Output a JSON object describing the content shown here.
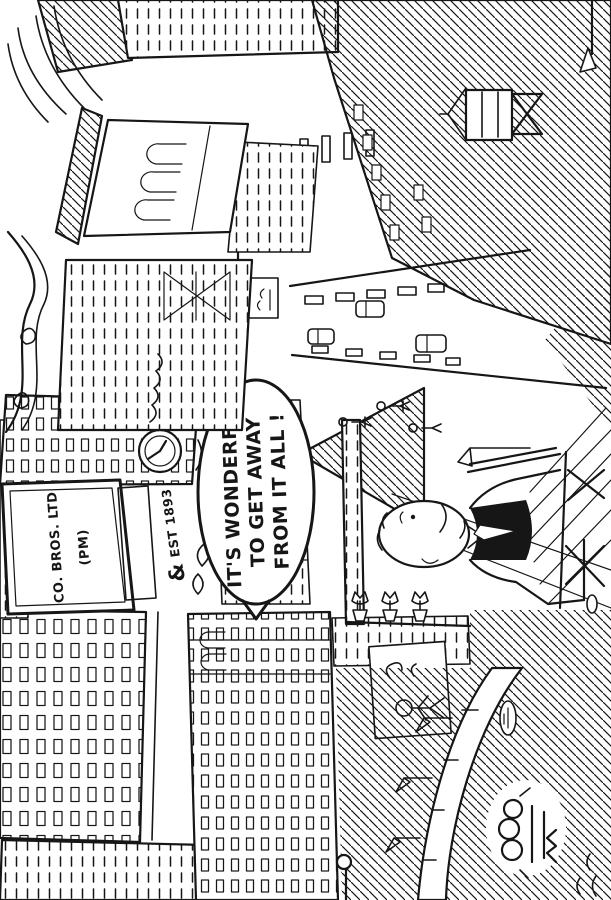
{
  "colors": {
    "ink": "#161616",
    "paper": "#ffffff"
  },
  "artwork": {
    "kind": "pen-and-ink cartoon, displayed rotated 90 degrees counter-clockwise",
    "speech_bubble": {
      "line1": "IT'S WONDERFUL",
      "line2": "TO GET AWAY",
      "line3": "FROM IT ALL !"
    },
    "billboard": {
      "line1": "CO. BROS. LTD",
      "line2": "(PM)"
    },
    "facade_sign": {
      "ampersand": "&",
      "established": "EST 1893"
    }
  }
}
